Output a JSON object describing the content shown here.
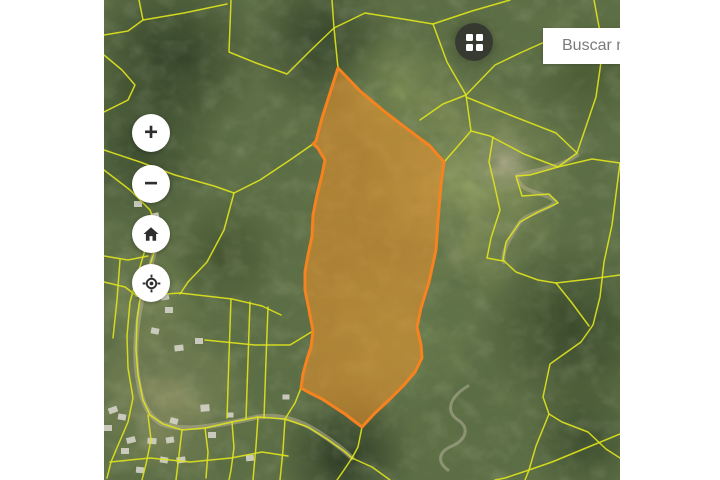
{
  "search": {
    "placeholder": "Buscar n"
  },
  "map_controls": {
    "zoom_in_label": "+",
    "zoom_out_label": "−",
    "home_icon": "home-icon",
    "locate_icon": "locate-icon"
  },
  "basemap_button": {
    "icon": "grid-icon"
  },
  "map": {
    "selected_parcel": "highlighted-parcel",
    "boundary_layer": "cadastral-parcel-lines"
  },
  "colors": {
    "parcel-stroke": "#F5831F",
    "parcel-fill": "rgba(248,150,40,0.52)",
    "boundary-yellow": "#DDE31D",
    "search-placeholder": "#7B7B7B",
    "button-icon": "#2E2E2E",
    "basemap-bg": "rgba(42,42,42,0.78)"
  }
}
